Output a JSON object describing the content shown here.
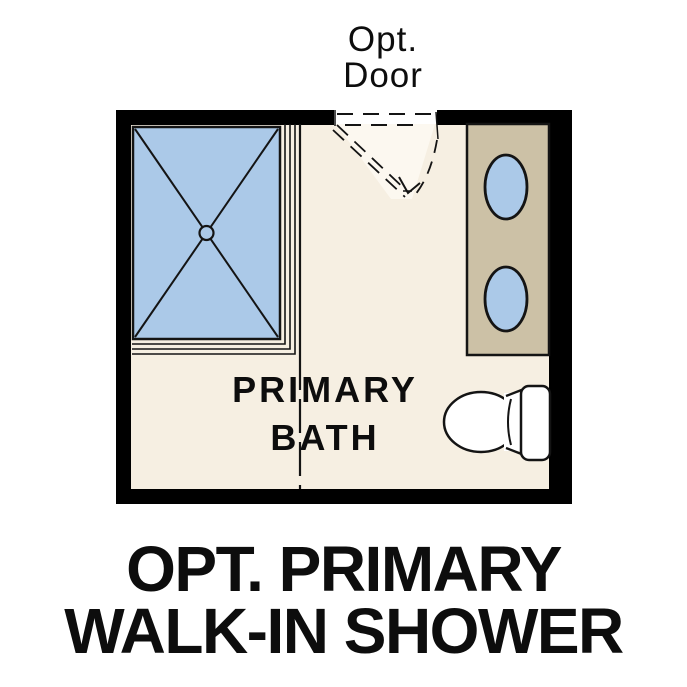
{
  "title": {
    "line1": "OPT. PRIMARY",
    "line2": "WALK-IN SHOWER"
  },
  "plan": {
    "door_label": {
      "line1": "Opt.",
      "line2": "Door"
    },
    "room_label": {
      "line1": "PRIMARY",
      "line2": "BATH"
    },
    "fixtures": {
      "shower": "walk-in shower with X pan and center drain",
      "vanity": "double-sink vanity counter",
      "toilet": "toilet with tank against right wall",
      "door": "optional door swing shown dashed"
    }
  },
  "colors": {
    "wall": "#000000",
    "floor": "#f6efe2",
    "door_area": "#fcf8f0",
    "fixture_blue": "#abc9e8",
    "vanity_tan": "#ccc1a6",
    "fixture_white": "#ffffff"
  }
}
